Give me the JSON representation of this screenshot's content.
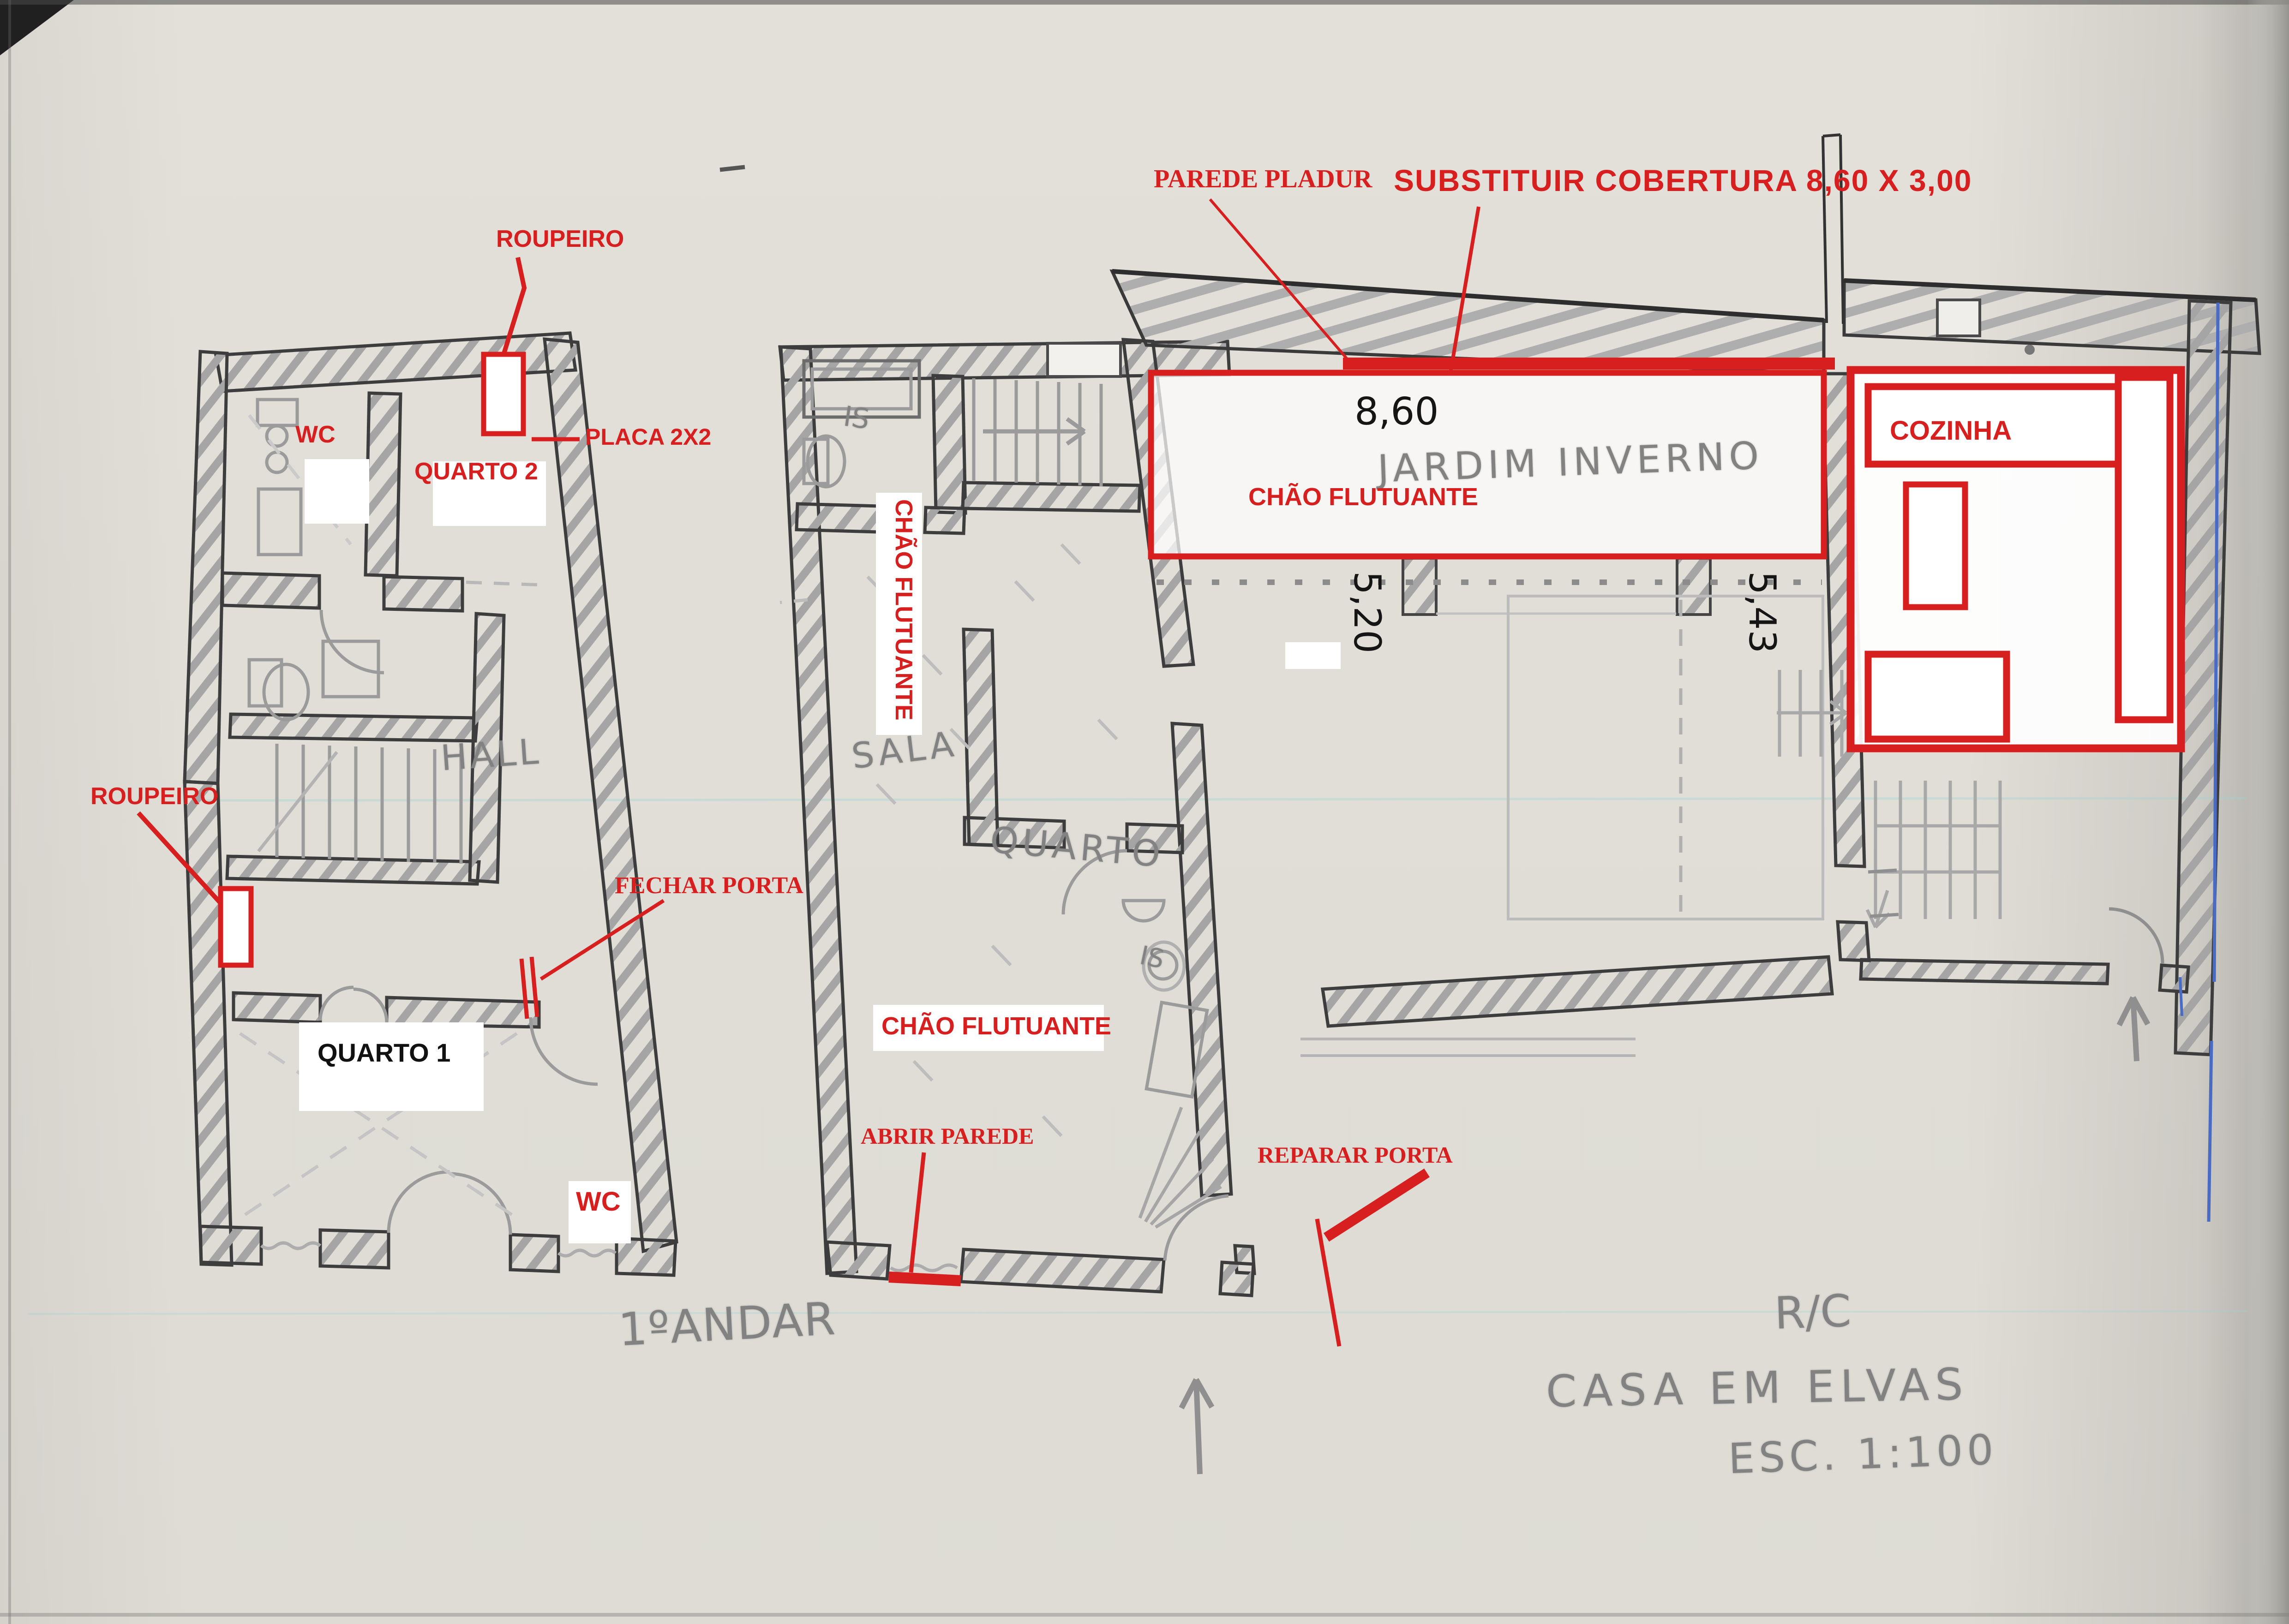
{
  "colors": {
    "annotation_red": "#d81f1f",
    "pen_blue": "#4a6bc4",
    "pencil_dark": "#3e3e3e",
    "pencil_mid": "#8a8a8a",
    "paper": "#f0efeb"
  },
  "first_floor": {
    "labels": {
      "roupeiro_top": "ROUPEIRO",
      "wc_top": "WC",
      "quarto2": "QUARTO 2",
      "placa": "PLACA 2X2",
      "hall": "HALL",
      "roupeiro_left": "ROUPEIRO",
      "fechar_porta": "FECHAR PORTA",
      "quarto1": "QUARTO 1",
      "wc_bottom": "WC"
    },
    "caption": "1ºANDAR"
  },
  "ground_floor": {
    "labels": {
      "is_top": "IS",
      "chao_flutuante_corridor": "CHÃO FLUTUANTE",
      "sala": "SALA",
      "quarto": "QUARTO",
      "is_mid": "IS",
      "chao_flutuante_sala": "CHÃO FLUTUANTE",
      "abrir_parede": "ABRIR PAREDE",
      "reparar_porta": "REPARAR PORTA",
      "parede_pladur": "PAREDE PLADUR",
      "substituir_cobertura": "SUBSTITUIR COBERTURA 8,60 X 3,00",
      "jardim_inverno": "JARDIM INVERNO",
      "chao_flutuante_jardim": "CHÃO FLUTUANTE",
      "cozinha": "COZINHA"
    },
    "dimensions": {
      "cover_width": "8,60",
      "left_depth": "5,20",
      "right_depth": "5,43"
    }
  },
  "titleblock": {
    "floor": "R/C",
    "title": "CASA EM ELVAS",
    "scale": "ESC. 1:100"
  }
}
